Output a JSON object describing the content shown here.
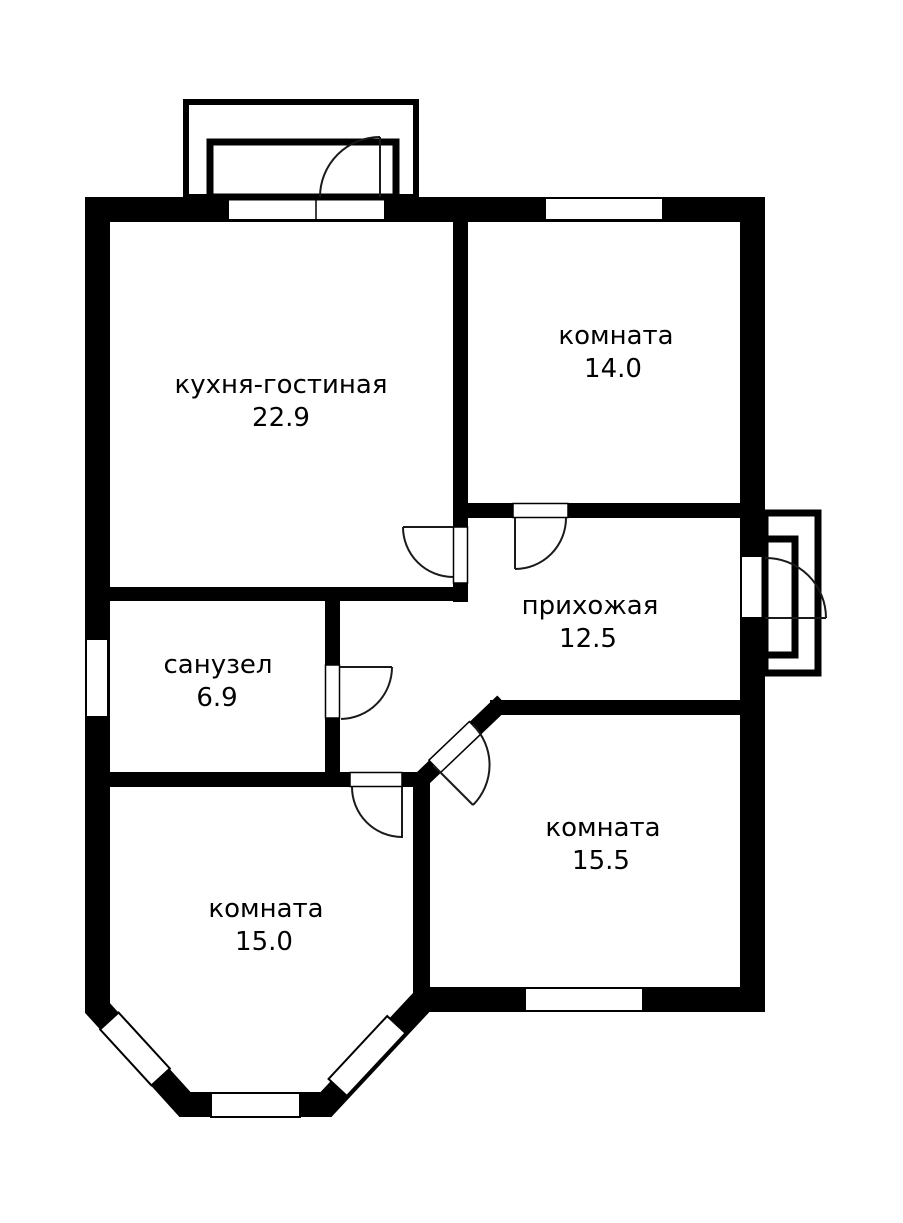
{
  "plan": {
    "type": "floor-plan",
    "colors": {
      "wall": "#000000",
      "background": "#ffffff",
      "line": "#1a1a1a"
    },
    "rooms": [
      {
        "id": "kitchen-living",
        "name": "кухня-гостиная",
        "area": "22.9"
      },
      {
        "id": "room-top-right",
        "name": "комната",
        "area": "14.0"
      },
      {
        "id": "hallway",
        "name": "прихожая",
        "area": "12.5"
      },
      {
        "id": "bathroom",
        "name": "санузел",
        "area": "6.9"
      },
      {
        "id": "room-bottom-right",
        "name": "комната",
        "area": "15.5"
      },
      {
        "id": "room-bottom-left",
        "name": "комната",
        "area": "15.0"
      }
    ]
  }
}
